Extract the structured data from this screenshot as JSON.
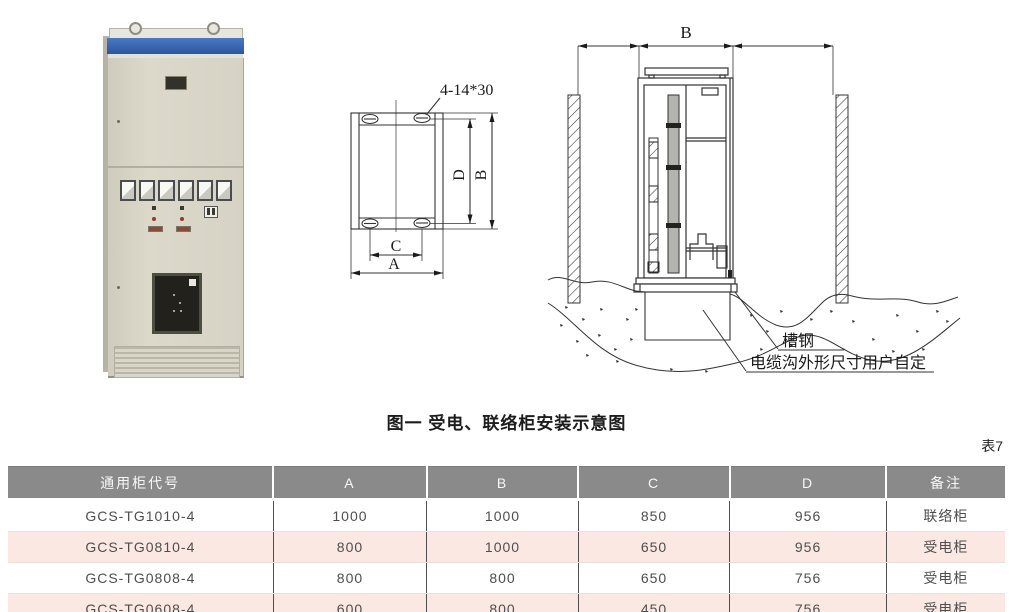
{
  "figure": {
    "caption": "图一 受电、联络柜安装示意图",
    "photo": {
      "description": "GCS low-voltage switchgear cabinet photo"
    },
    "plan": {
      "hole_label": "4-14*30",
      "dim_a": "A",
      "dim_b": "B",
      "dim_c": "C",
      "dim_d": "D"
    },
    "install": {
      "dim_b": "B",
      "label_channel_steel": "槽钢",
      "label_cable_trench": "电缆沟外形尺寸用户自定"
    }
  },
  "table_tag": "表7",
  "table": {
    "headers": [
      "通用柜代号",
      "A",
      "B",
      "C",
      "D",
      "备注"
    ],
    "rows": [
      [
        "GCS-TG1010-4",
        "1000",
        "1000",
        "850",
        "956",
        "联络柜"
      ],
      [
        "GCS-TG0810-4",
        "800",
        "1000",
        "650",
        "956",
        "受电柜"
      ],
      [
        "GCS-TG0808-4",
        "800",
        "800",
        "650",
        "756",
        "受电柜"
      ],
      [
        "GCS-TG0608-4",
        "600",
        "800",
        "450",
        "756",
        "受电柜"
      ]
    ]
  },
  "colors": {
    "table_header_bg": "#8a8a8a",
    "table_alt_row_bg": "#fbe8e3",
    "cabinet_blue_band": "#3160ae",
    "line_color": "#333333"
  }
}
